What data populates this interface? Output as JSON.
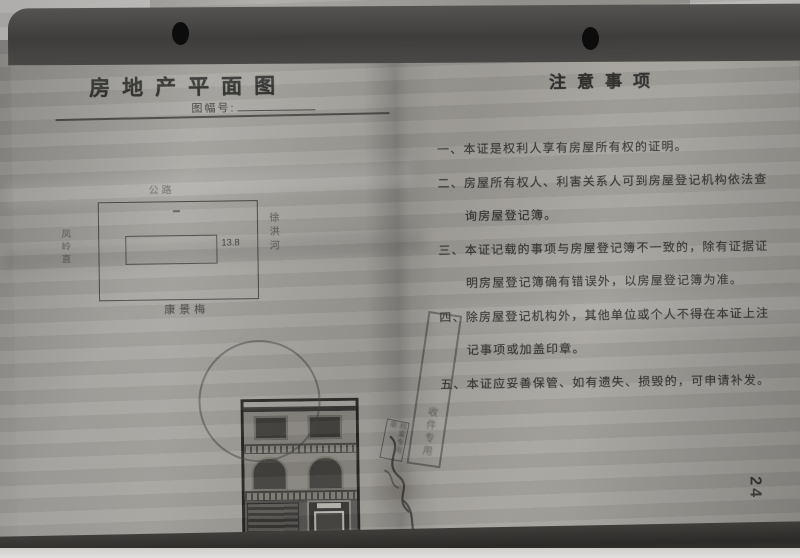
{
  "left_page": {
    "title": "房地产平面图",
    "sheet_no_label": "图幅号:",
    "plan": {
      "top": "公路",
      "left": "凤岭直",
      "right": "徐洪河",
      "bottom": "康景梅",
      "dimension": "13.8"
    }
  },
  "right_page": {
    "title": "注意事项",
    "items": [
      "一、本证是权利人享有房屋所有权的证明。",
      "二、房屋所有权人、利害关系人可到房屋登记机构依法查询房屋登记簿。",
      "三、本证记载的事项与房屋登记簿不一致的，除有证据证明房屋登记簿确有错误外，以房屋登记簿为准。",
      "四、除房屋登记机构外，其他单位或个人不得在本证上注记事项或加盖印章。",
      "五、本证应妥善保管、如有遗失、损毁的，可申请补发。"
    ]
  },
  "stamps": {
    "diagonal": "收件专用",
    "small": "档案专用章"
  },
  "page_number": "24",
  "colors": {
    "paper": "#a8a6a1",
    "binding_band": "#434240",
    "shadow": "#2f2e2b",
    "ink": "#282826"
  }
}
